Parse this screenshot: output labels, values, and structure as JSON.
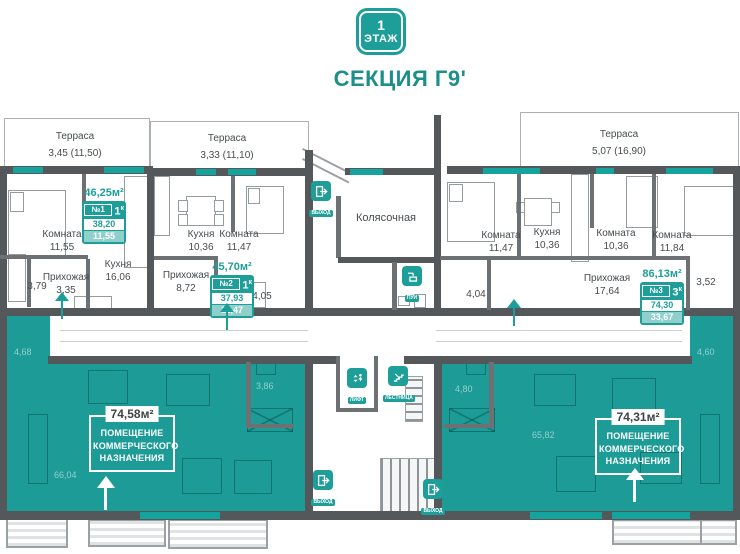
{
  "header": {
    "floor_number": "1",
    "floor_label": "ЭТАЖ",
    "section_title": "СЕКЦИЯ Г9'"
  },
  "terraces": [
    {
      "name": "Терраса",
      "area": "3,45 (11,50)"
    },
    {
      "name": "Терраса",
      "area": "3,33 (11,10)"
    },
    {
      "name": "Терраса",
      "area": "5,07 (16,90)"
    }
  ],
  "apartments": [
    {
      "title": "46,25м²",
      "number": "№1",
      "rooms_count": "1",
      "rooms_suffix": "к",
      "area_main": "38,20",
      "area_living": "11,55",
      "room_labels": [
        {
          "name": "Комната",
          "area": "11,55"
        },
        {
          "name": "Кухня",
          "area": "16,06"
        },
        {
          "name": "Прихожая",
          "area": "3,35"
        },
        {
          "name": "",
          "area": "3,79"
        }
      ]
    },
    {
      "title": "45,70м²",
      "number": "№2",
      "rooms_count": "1",
      "rooms_suffix": "к",
      "area_main": "37,93",
      "area_living": "11,47",
      "room_labels": [
        {
          "name": "Кухня",
          "area": "10,36"
        },
        {
          "name": "Комната",
          "area": "11,47"
        },
        {
          "name": "Прихожая",
          "area": "8,72"
        },
        {
          "name": "",
          "area": "4,05"
        }
      ]
    },
    {
      "title": "86,13м²",
      "number": "№3",
      "rooms_count": "3",
      "rooms_suffix": "к",
      "area_main": "74,30",
      "area_living": "33,67",
      "room_labels": [
        {
          "name": "Комната",
          "area": "11,47"
        },
        {
          "name": "Кухня",
          "area": "10,36"
        },
        {
          "name": "Комната",
          "area": "10,36"
        },
        {
          "name": "Комната",
          "area": "11,84"
        },
        {
          "name": "Прихожая",
          "area": "17,64"
        },
        {
          "name": "",
          "area": "4,04"
        },
        {
          "name": "",
          "area": "3,52"
        }
      ]
    }
  ],
  "common_areas": {
    "stroller_room": "Колясочная"
  },
  "icon_labels": {
    "exit": "ВЫХОД",
    "cleaning": "ПУИ",
    "lift": "ЛИФТ",
    "stairs": "ЛЕСТНИЦА"
  },
  "commercial": [
    {
      "area": "74,58м²",
      "label_lines": [
        "ПОМЕЩЕНИЕ",
        "КОММЕРЧЕСКОГО",
        "НАЗНАЧЕНИЯ"
      ],
      "sub_areas": [
        "4,68",
        "3,86",
        "66,04"
      ]
    },
    {
      "area": "74,31м²",
      "label_lines": [
        "ПОМЕЩЕНИЕ",
        "КОММЕРЧЕСКОГО",
        "НАЗНАЧЕНИЯ"
      ],
      "sub_areas": [
        "4,80",
        "4,60",
        "65,82"
      ]
    }
  ],
  "colors": {
    "accent": "#1E9E99",
    "wall": "#55585B"
  }
}
